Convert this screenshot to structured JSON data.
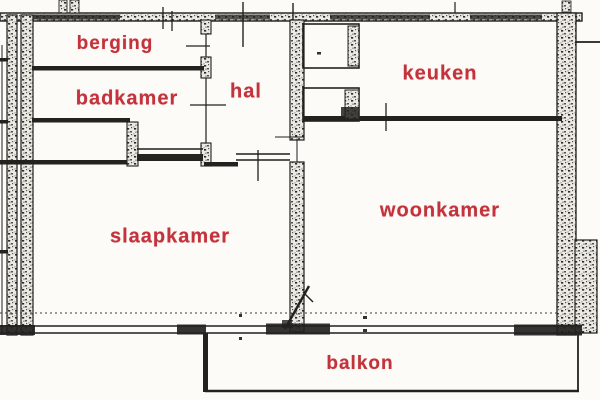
{
  "colors": {
    "label_red": "#c4333c",
    "wall_ink": "#1f1e1c",
    "paper": "#fcfbf8"
  },
  "rooms": [
    {
      "id": "berging",
      "label": "berging"
    },
    {
      "id": "badkamer",
      "label": "badkamer"
    },
    {
      "id": "hal",
      "label": "hal"
    },
    {
      "id": "keuken",
      "label": "keuken"
    },
    {
      "id": "slaapkamer",
      "label": "slaapkamer"
    },
    {
      "id": "woonkamer",
      "label": "woonkamer"
    },
    {
      "id": "balkon",
      "label": "balkon"
    }
  ]
}
